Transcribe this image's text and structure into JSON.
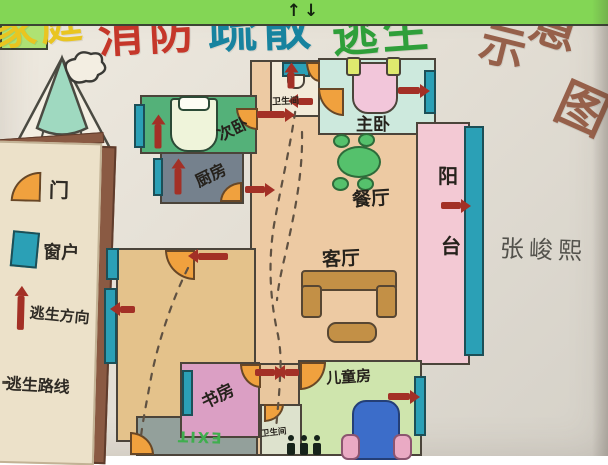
{
  "title": {
    "segments": [
      {
        "text": "家庭",
        "color": "#e9c520"
      },
      {
        "text": "消防",
        "color": "#c5372a"
      },
      {
        "text": "疏散",
        "color": "#17839f"
      },
      {
        "text": "逃生",
        "color": "#2f9f3a"
      },
      {
        "text": "示",
        "color": "#96604a"
      },
      {
        "text": "意",
        "color": "#96604a"
      },
      {
        "text": "图",
        "color": "#96604a"
      }
    ],
    "full_title": "家庭消防疏散逃生示意图"
  },
  "legend": {
    "door_label": "门",
    "window_label": "窗户",
    "direction_label": "逃生方向",
    "route_label": "逃生路线"
  },
  "rooms": {
    "bathroom_top": "卫生间",
    "master_bedroom": "主卧",
    "second_bedroom": "次卧",
    "kitchen": "厨房",
    "dining_room": "餐厅",
    "living_room": "客厅",
    "balcony_char1": "阳",
    "balcony_char2": "台",
    "study": "书房",
    "kids_room": "儿童房",
    "bathroom_bottom": "卫生间",
    "exit_label": "EXIT"
  },
  "elevator": {
    "arrows": "↑↓"
  },
  "signature": "张峻熙",
  "colors": {
    "escape_arrow": "#a33026",
    "door": "#f0a13e",
    "window": "#2ba0b6",
    "route_dash": "#5f5142",
    "wall": "#4b443a"
  }
}
